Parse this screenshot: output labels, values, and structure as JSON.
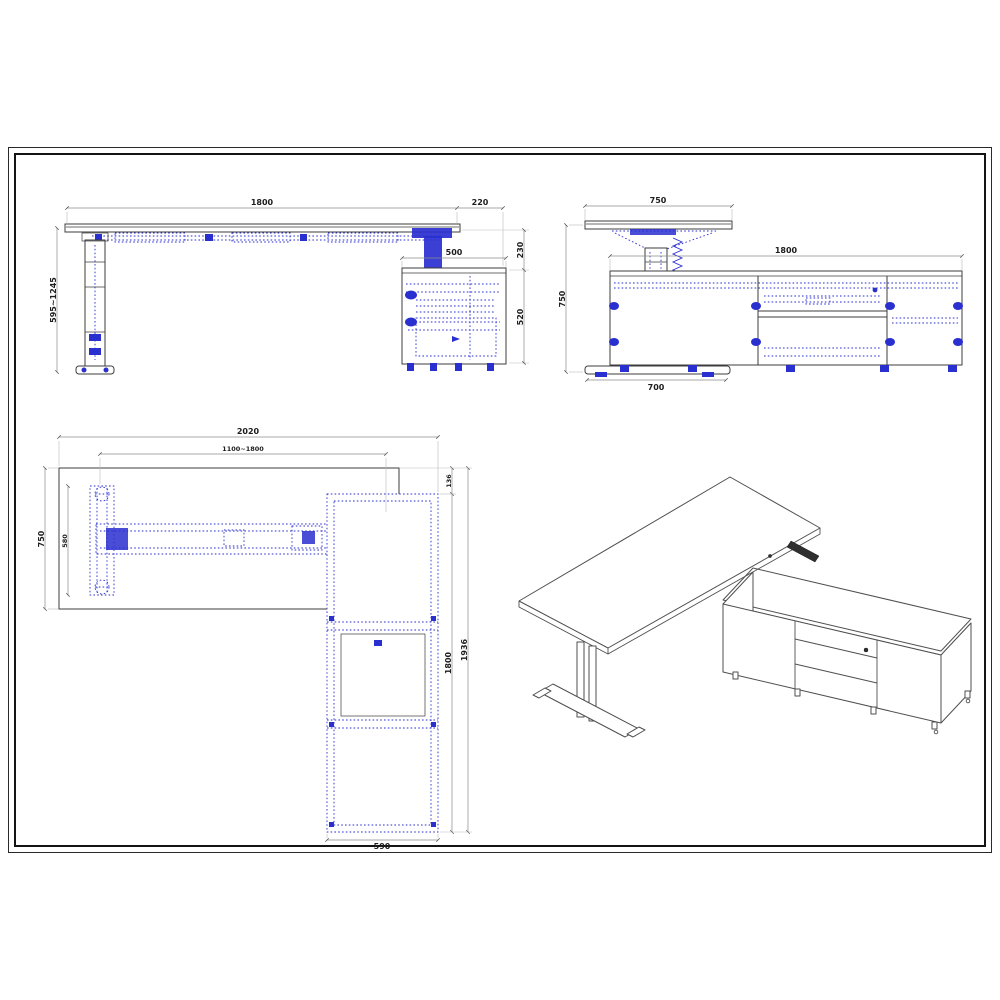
{
  "colors": {
    "paper": "#ffffff",
    "frame": "#1c1c1c",
    "outline": "#3c3c3c",
    "hidden_detail_blue": "#2a2fd0",
    "dimension_line": "#8c8c8c",
    "dimension_text": "#1d1d1d"
  },
  "views": {
    "front_elevation": {
      "dims": {
        "desk_width": "1800",
        "cabinet_overhang": "220",
        "height_range": "595~1245",
        "cabinet_width": "500",
        "desk_to_cabinet_gap": "230",
        "cabinet_height": "520"
      }
    },
    "side_elevation": {
      "dims": {
        "desk_depth": "750",
        "cabinet_length": "1800",
        "overall_height": "750",
        "foot_length": "700"
      }
    },
    "plan_view": {
      "dims": {
        "overall_width": "2020",
        "frame_adjust_range": "1100~1800",
        "desk_depth": "750",
        "foot_span": "580",
        "return_gap": "136",
        "cabinet_length": "1800",
        "overall_return_length": "1936",
        "cabinet_depth": "590"
      }
    },
    "isometric_view": {}
  }
}
